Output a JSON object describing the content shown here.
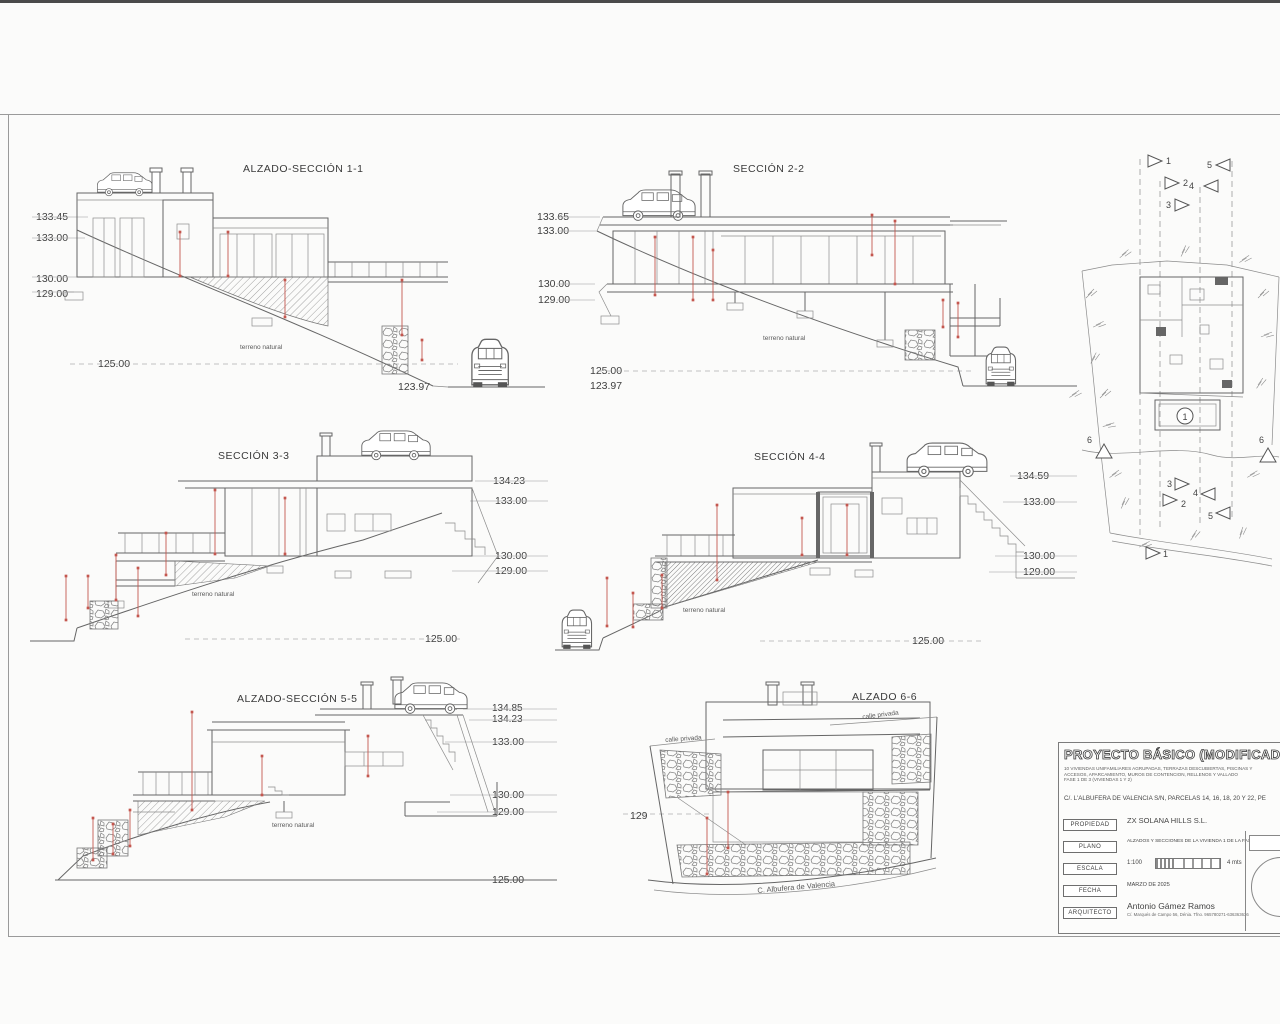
{
  "s1": {
    "title": "ALZADO-SECCIÓN 1-1",
    "levels": [
      "133.45",
      "133.00",
      "130.00",
      "129.00"
    ],
    "ground": "125.00",
    "street": "123.97",
    "terrain": "terreno natural"
  },
  "s2": {
    "title": "SECCIÓN 2-2",
    "levels": [
      "133.65",
      "133.00",
      "130.00",
      "129.00"
    ],
    "ground": "125.00",
    "street": "123.97",
    "terrain": "terreno natural"
  },
  "s3": {
    "title": "SECCIÓN 3-3",
    "levels": [
      "134.23",
      "133.00",
      "130.00",
      "129.00"
    ],
    "ground": "125.00",
    "terrain": "terreno natural"
  },
  "s4": {
    "title": "SECCIÓN 4-4",
    "levels": [
      "134.59",
      "133.00",
      "130.00",
      "129.00"
    ],
    "ground": "125.00",
    "terrain": "terreno natural"
  },
  "s5": {
    "title": "ALZADO-SECCIÓN 5-5",
    "levels": [
      "134.85",
      "134.23",
      "133.00",
      "130.00",
      "129.00",
      "125.00"
    ],
    "terrain": "terreno natural"
  },
  "s6": {
    "title": "ALZADO 6-6",
    "level": "129",
    "street": "C. Albufera de Valencia",
    "calle_left": "calle privada",
    "calle_right": "calle privada"
  },
  "siteplan": {
    "top_markers": [
      "1",
      "2",
      "3",
      "4",
      "5"
    ],
    "bottom_markers": [
      "3",
      "2",
      "4",
      "5",
      "1"
    ],
    "side_markers": [
      "6",
      "6"
    ],
    "pool": "1"
  },
  "titleblock": {
    "title": "PROYECTO BÁSICO (MODIFICADO 1)",
    "sub1": "10 VIVIENDAS UNIFAMILIARES AGRUPADAS, TERRAZAS DESCUBIERTAS, PISCINAS Y",
    "sub2": "ACCESOS, APARCAMIENTO, MUROS DE CONTENCION, RELLENOS Y VALLADO",
    "sub3": "FASE 1 DE 3 (VIVIENDAS 1 Y 2)",
    "address": "C/. L'ALBUFERA DE VALENCIA S/N, PARCELAS 14, 16, 18, 20 Y 22, PE",
    "rows": {
      "propiedad_label": "PROPIEDAD",
      "propiedad": "ZX SOLANA HILLS S.L.",
      "plano_label": "PLANO",
      "plano": "ALZADOS Y SECCIONES DE LA VIVIENDA 1 DE LA FASE 1.",
      "escala_label": "ESCALA",
      "escala": "1:100",
      "escala_mts": "4 mts",
      "fecha_label": "FECHA",
      "fecha": "MARZO DE 2025",
      "arquitecto_label": "ARQUITECTO",
      "arquitecto": "Antonio Gámez Ramos",
      "arquitecto_sub": "C/. Marqués de Campo 56, Dénia. Tfno. 965780271-636363636"
    }
  }
}
